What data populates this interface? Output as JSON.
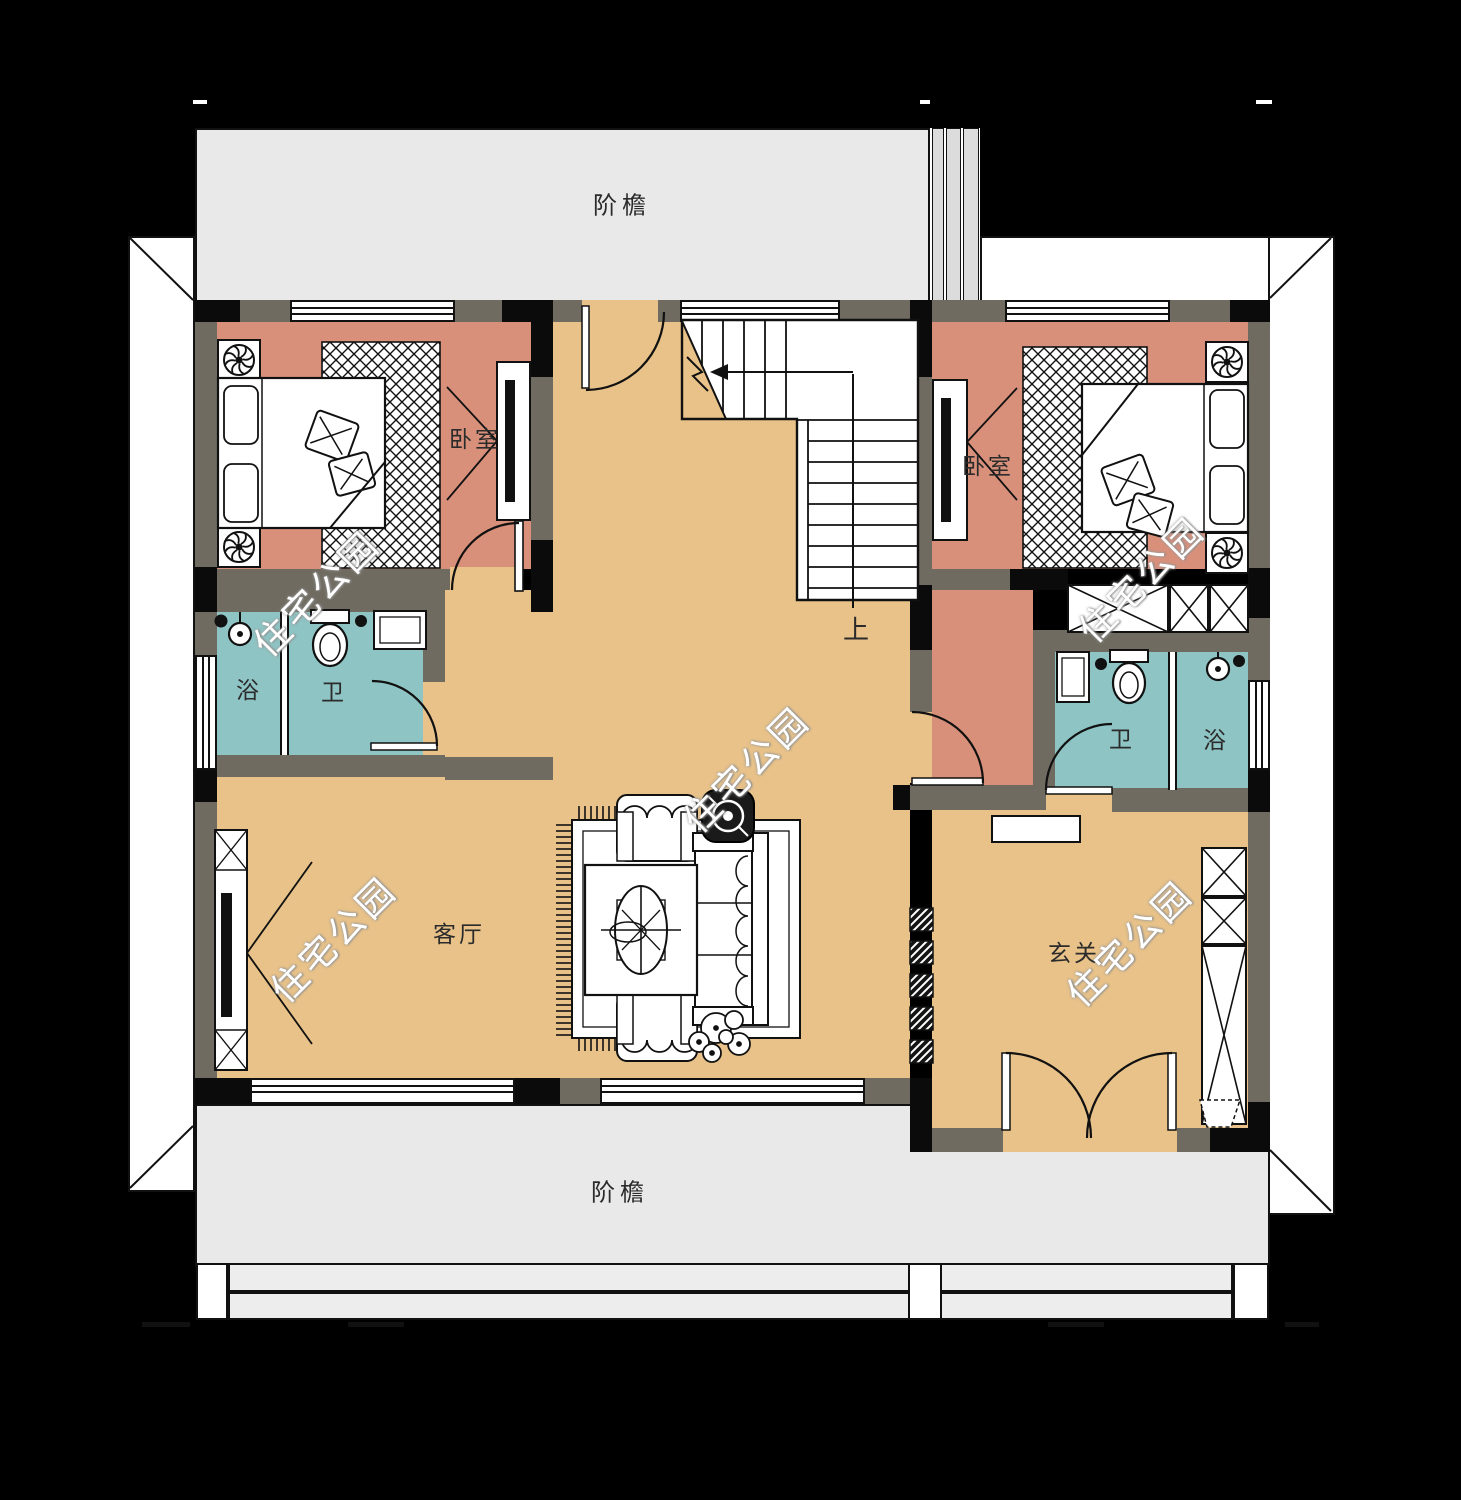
{
  "plan": {
    "labels": {
      "porch_top": "阶檐",
      "porch_bottom": "阶檐",
      "bedroom_left": "卧室",
      "bedroom_right": "卧室",
      "bath_left": "浴",
      "wc_left": "卫",
      "wc_right": "卫",
      "bath_right": "浴",
      "living": "客厅",
      "foyer": "玄关",
      "stairs_up": "上"
    },
    "watermark": "住宅公园",
    "colors": {
      "background": "#000000",
      "bedroom_floor": "#d8907b",
      "hall_floor": "#e8c289",
      "bath_floor": "#8fc4c4",
      "wall": "#6f6b60",
      "wall_dark": "#0b0b0b",
      "porch": "#e9e9e9",
      "line": "#111111"
    }
  }
}
